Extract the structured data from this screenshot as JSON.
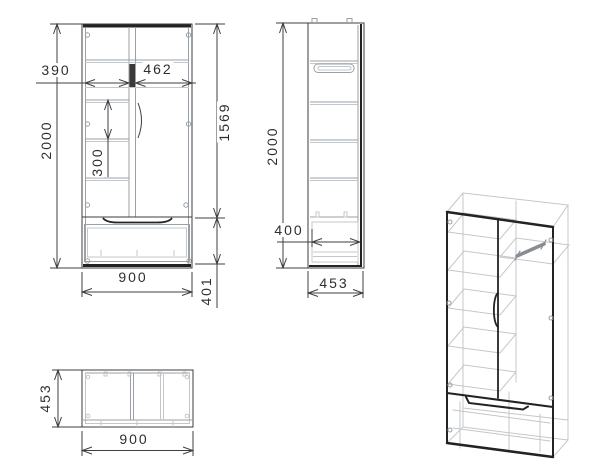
{
  "drawing_type": "furniture-technical-drawing",
  "colors": {
    "background": "#ffffff",
    "line": "#3c3c3c",
    "dim_line": "#3f3f3f",
    "light_line": "#c3c7cb",
    "mid_line": "#9aa0a5",
    "dark_line": "#232323",
    "text": "#2e2e2e"
  },
  "views": {
    "front": {
      "dims": {
        "total_height": "2000",
        "left_section_width": "390",
        "right_section_width": "462",
        "shelf_spacing": "300",
        "upper_section_height": "1569",
        "total_width": "900",
        "drawer_section_height": "401"
      }
    },
    "side": {
      "dims": {
        "total_height": "2000",
        "drawer_depth": "400",
        "total_depth": "453"
      }
    },
    "top": {
      "dims": {
        "total_depth": "453",
        "total_width": "900"
      }
    }
  }
}
